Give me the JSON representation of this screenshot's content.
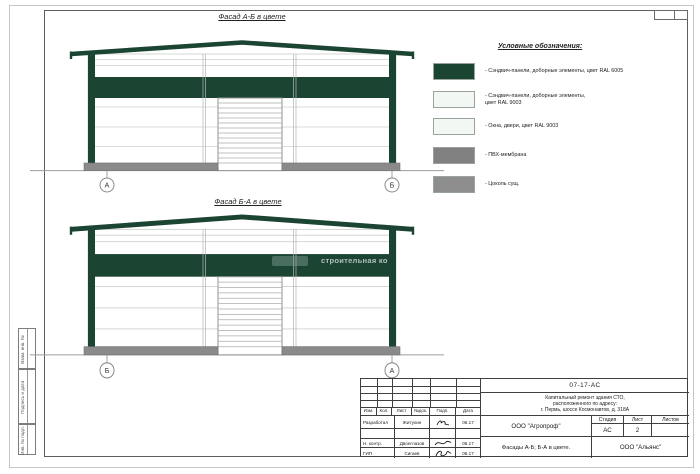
{
  "facades": [
    {
      "title": "Фасад А-Б в цвете",
      "markers": {
        "left": "А",
        "right": "Б"
      }
    },
    {
      "title": "Фасад Б-А в цвете",
      "markers": {
        "left": "Б",
        "right": "А"
      }
    }
  ],
  "legend": {
    "title": "Условные обозначения:",
    "items": [
      {
        "label": "- Сэндвич-панели, доборные элементы,  цвет RAL 6005",
        "color": "#1b4433"
      },
      {
        "label": "- Сэндвич-панели, доборные элементы,\nцвет RAL 9003",
        "color": "#f3f7f3"
      },
      {
        "label": "- Окна, двери, цвет RAL 9003",
        "color": "#f3f7f3"
      },
      {
        "label": "- ПВХ-мембрана",
        "color": "#818181"
      },
      {
        "label": "- Цоколь сущ.",
        "color": "#8d8d8d"
      }
    ]
  },
  "watermark": {
    "text": "строительная ко"
  },
  "sidebar": {
    "boxes": [
      "Взам. инв. №",
      "Подпись и дата",
      "Инв. № подл."
    ]
  },
  "titleblock": {
    "doc_number": "07-17-АС",
    "project_lines": [
      "Капитальный ремонт здания СТО,",
      "расположенного по адресу:",
      "г. Пермь, шоссе Космонавтов, д. 318А"
    ],
    "header_cols": [
      "Изм.",
      "Кол.",
      "Лист",
      "№док.",
      "Подп.",
      "Дата"
    ],
    "rows": [
      {
        "role": "Разработал",
        "name": "Житухин",
        "date": "06.17"
      },
      {
        "role": "",
        "name": "",
        "date": ""
      },
      {
        "role": "Н. контр.",
        "name": "Двоеглазов",
        "date": "06.17"
      },
      {
        "role": "ГИП",
        "name": "Сигаев",
        "date": "06.17"
      }
    ],
    "org_designer": "ООО \"Агропроф\"",
    "org_contractor": "ООО \"Альянс\"",
    "sheet_title": "Фасады А-Б; Б-А в цвете.",
    "stage_label": "Стадия",
    "list_label": "Лист",
    "listov_label": "Листов",
    "stage_value": "АС",
    "list_value": "2",
    "listov_value": ""
  }
}
